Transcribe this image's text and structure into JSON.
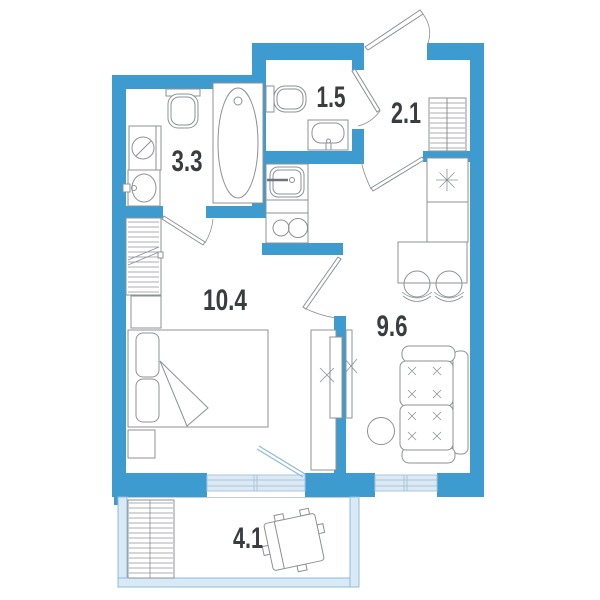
{
  "plan": {
    "type": "apartment-floor-plan",
    "rooms": [
      {
        "id": "bathroom",
        "area": "3.3"
      },
      {
        "id": "toilet",
        "area": "1.5"
      },
      {
        "id": "hallway",
        "area": "2.1"
      },
      {
        "id": "bedroom-living",
        "area": "10.4"
      },
      {
        "id": "kitchen-living",
        "area": "9.6"
      },
      {
        "id": "balcony",
        "area": "4.1"
      }
    ]
  },
  "colors": {
    "wall": "#3E9BD0",
    "window_fill": "#DCE9F4",
    "window_stroke": "#A7C5DB",
    "balcony_fill": "#D9E9F5",
    "glazing_stroke": "#8FBCDB",
    "furniture": "#8C9196",
    "label": "#3A3D40"
  }
}
